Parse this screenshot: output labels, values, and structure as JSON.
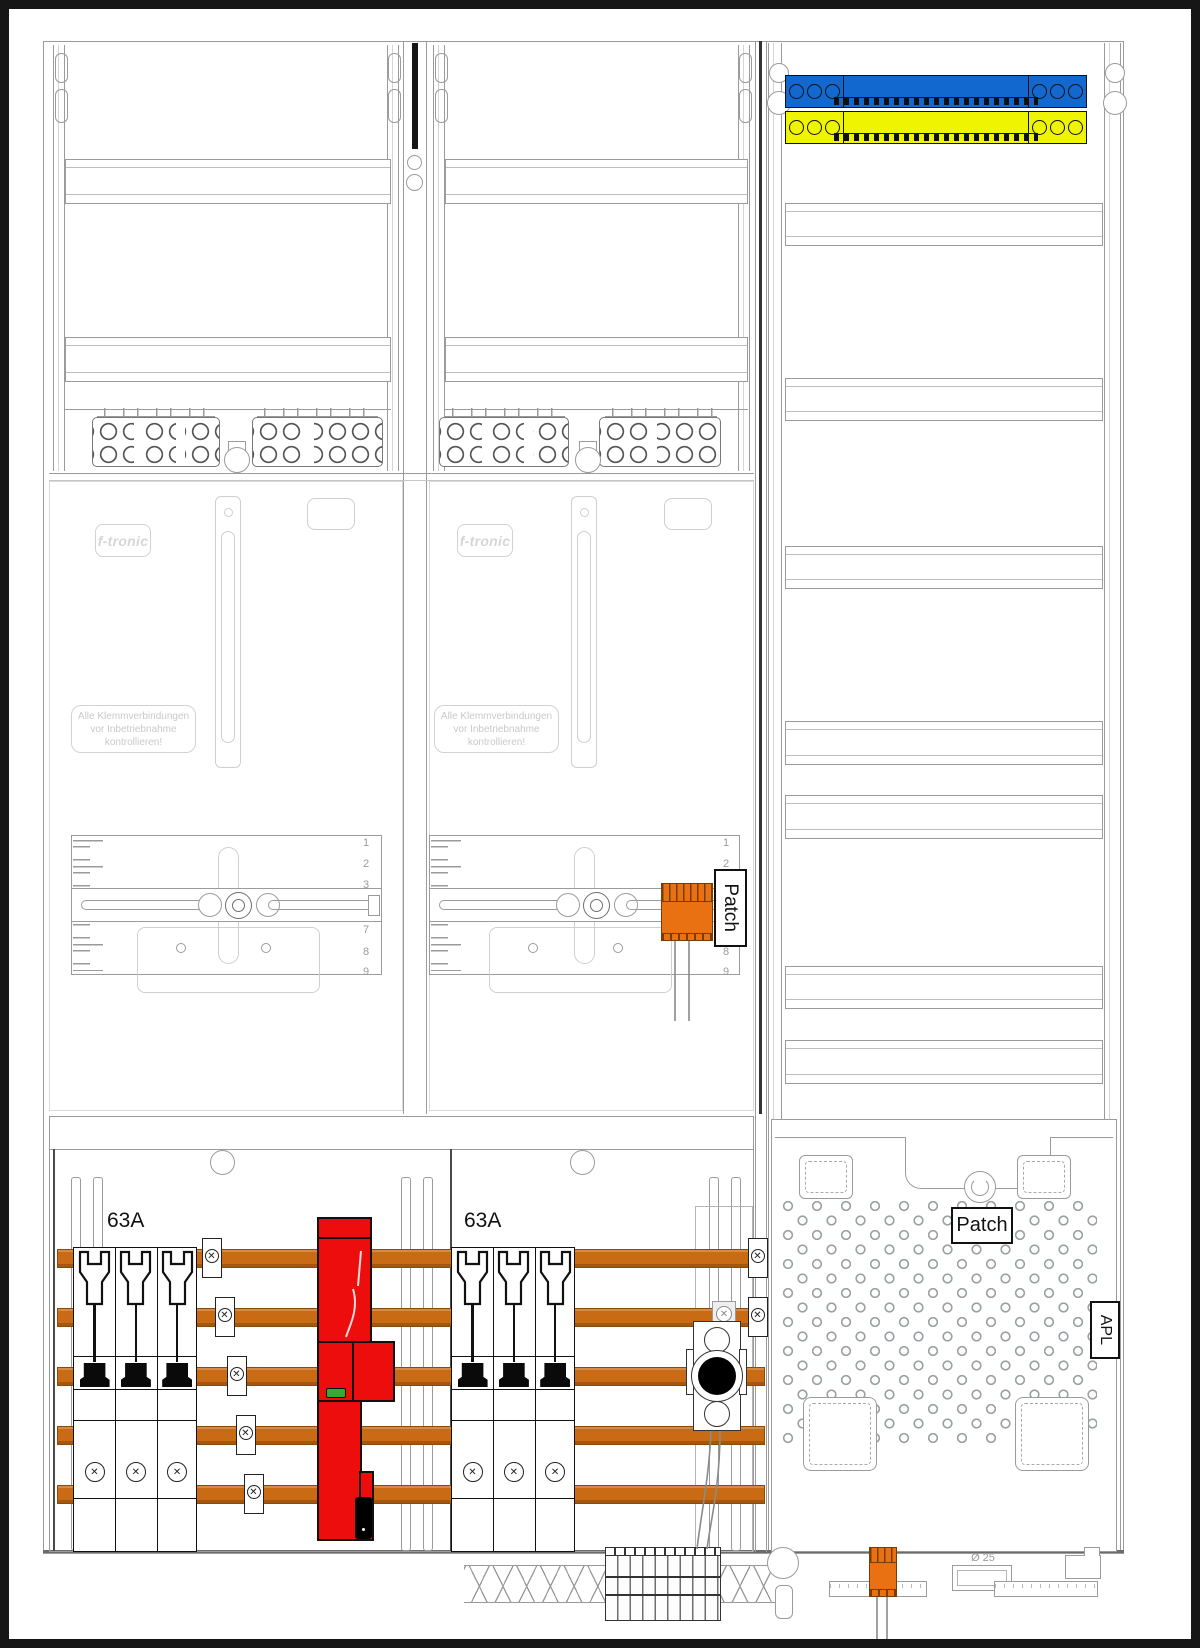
{
  "colors": {
    "busbar_orange": "#C96B14",
    "sls_red": "#EE0D0D",
    "indicator_green": "#3DA829",
    "busbar_blue": "#1368CF",
    "busbar_yellow": "#EFF400",
    "connector_orange": "#E97112"
  },
  "meter_fields": {
    "brand": "f-tronic",
    "warning": [
      "Alle Klemmverbindungen",
      "vor Inbetriebnahme",
      "kontrollieren!"
    ],
    "scale_top": [
      "1",
      "2",
      "3"
    ],
    "scale_bottom": [
      "6",
      "7",
      "8",
      "9"
    ],
    "patch_rail_label": "Patch"
  },
  "distribution": {
    "left_breaker_rating": "63A",
    "middle_breaker_rating": "63A"
  },
  "apl_field": {
    "patch_label": "Patch",
    "apl_label": "APL",
    "conduit_label": "Ø 25"
  }
}
